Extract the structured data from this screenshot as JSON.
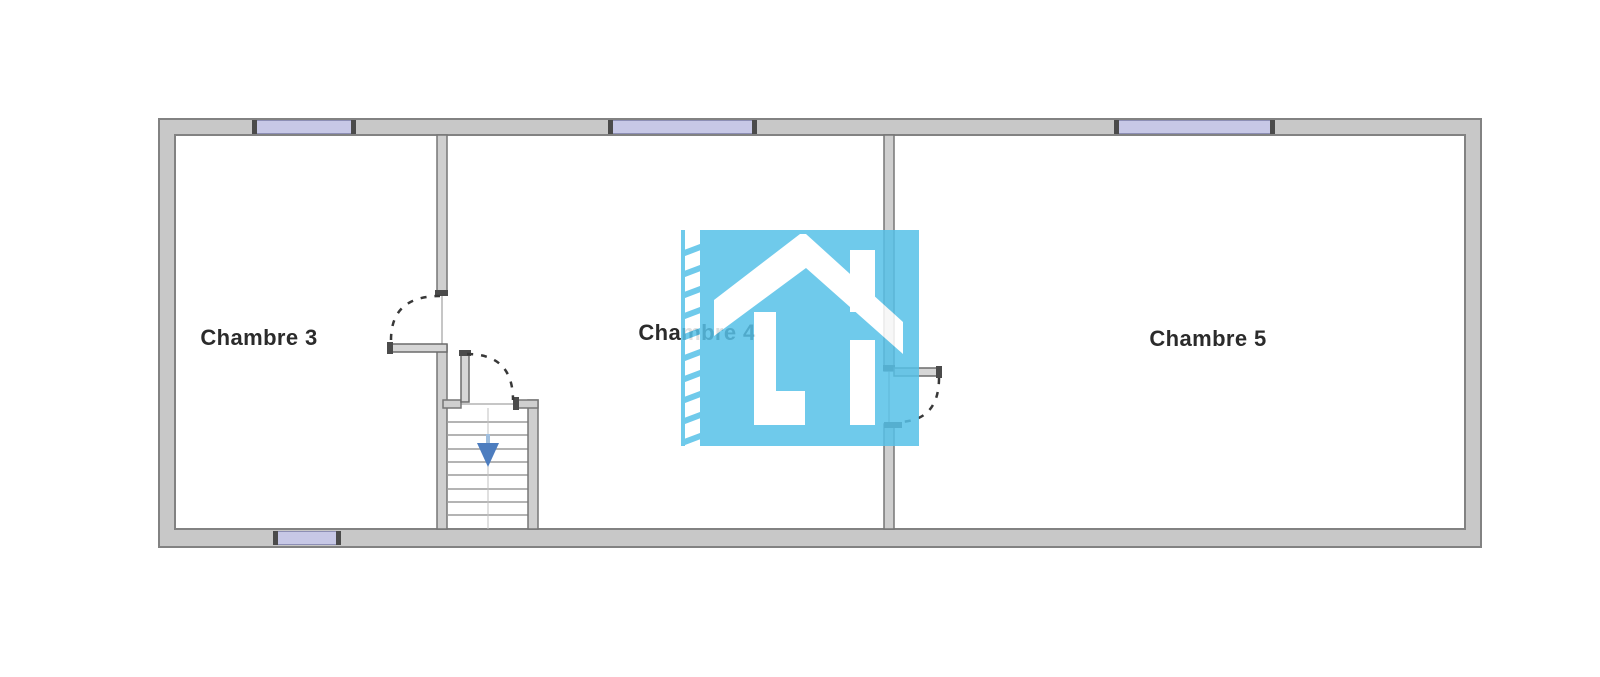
{
  "plan": {
    "type": "floor-plan",
    "rooms": [
      {
        "label": "Chambre 3"
      },
      {
        "label": "Chambre 4"
      },
      {
        "label": "Chambre 5"
      }
    ],
    "stairs": {
      "arrow_direction": "down"
    },
    "watermark": {
      "icon_name": "house-logo"
    }
  },
  "colors": {
    "wall_fill": "#c8c8c8",
    "wall_line": "#828282",
    "window_fill": "#c7c8e6",
    "logo_blue": "#57c1e8",
    "arrow_blue": "#4d7dbf",
    "label_text": "#2b2b2b"
  }
}
